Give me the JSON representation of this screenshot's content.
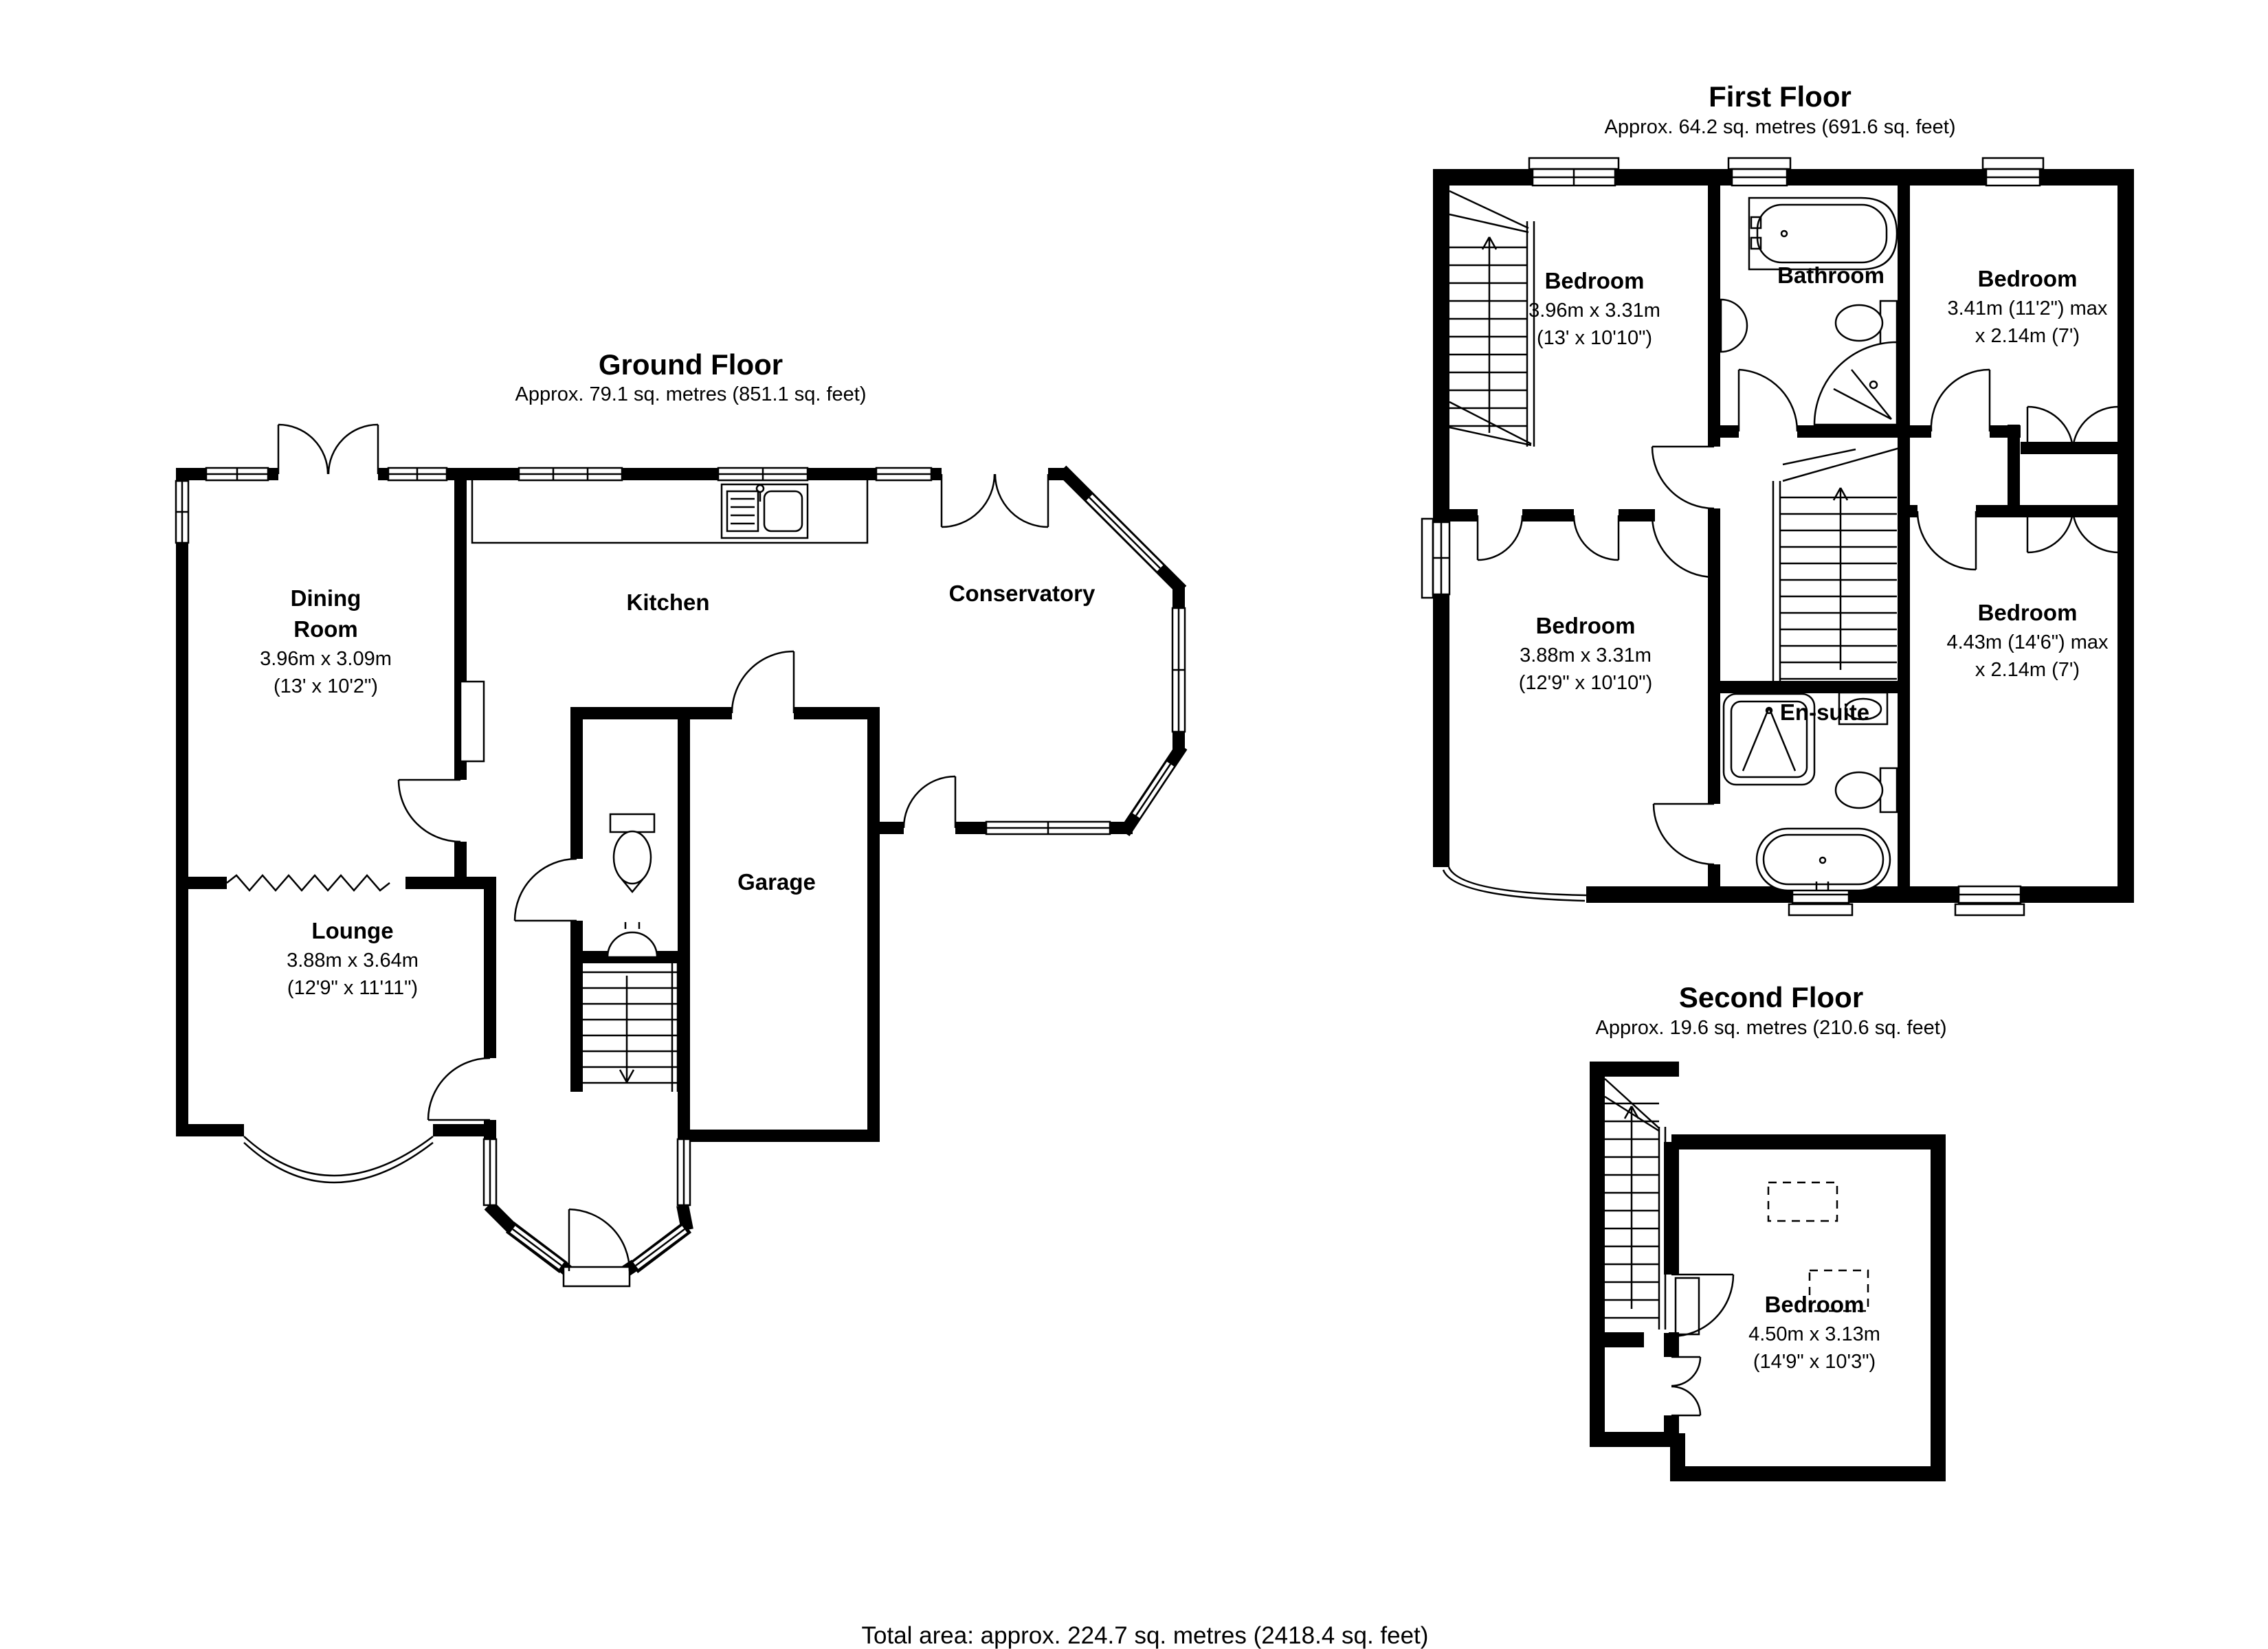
{
  "page": {
    "background_color": "#ffffff",
    "ink_color": "#000000"
  },
  "floors": [
    {
      "title": "Ground Floor",
      "subtitle": "Approx. 79.1 sq. metres (851.1 sq. feet)",
      "rooms": [
        {
          "name_line1": "Dining",
          "name_line2": "Room",
          "dims_m": "3.96m x 3.09m",
          "dims_ft": "(13' x 10'2\")"
        },
        {
          "name": "Kitchen"
        },
        {
          "name": "Conservatory"
        },
        {
          "name": "Lounge",
          "dims_m": "3.88m x 3.64m",
          "dims_ft": "(12'9\" x 11'11\")"
        },
        {
          "name": "Garage"
        }
      ]
    },
    {
      "title": "First Floor",
      "subtitle": "Approx. 64.2 sq. metres (691.6 sq. feet)",
      "rooms": [
        {
          "name": "Bedroom",
          "dims_m": "3.96m x 3.31m",
          "dims_ft": "(13' x 10'10\")"
        },
        {
          "name": "Bathroom"
        },
        {
          "name": "Bedroom",
          "dims_m": "3.41m (11'2\") max",
          "dims_ft": "x 2.14m (7')"
        },
        {
          "name": "Bedroom",
          "dims_m": "3.88m x 3.31m",
          "dims_ft": "(12'9\" x 10'10\")"
        },
        {
          "name": "En-suite"
        },
        {
          "name": "Bedroom",
          "dims_m": "4.43m (14'6\") max",
          "dims_ft": "x 2.14m (7')"
        }
      ]
    },
    {
      "title": "Second Floor",
      "subtitle": "Approx. 19.6 sq. metres (210.6 sq. feet)",
      "rooms": [
        {
          "name": "Bedroom",
          "dims_m": "4.50m x 3.13m",
          "dims_ft": "(14'9\" x 10'3\")"
        }
      ]
    }
  ],
  "footer": {
    "total_area": "Total area: approx. 224.7 sq. metres (2418.4 sq. feet)"
  }
}
